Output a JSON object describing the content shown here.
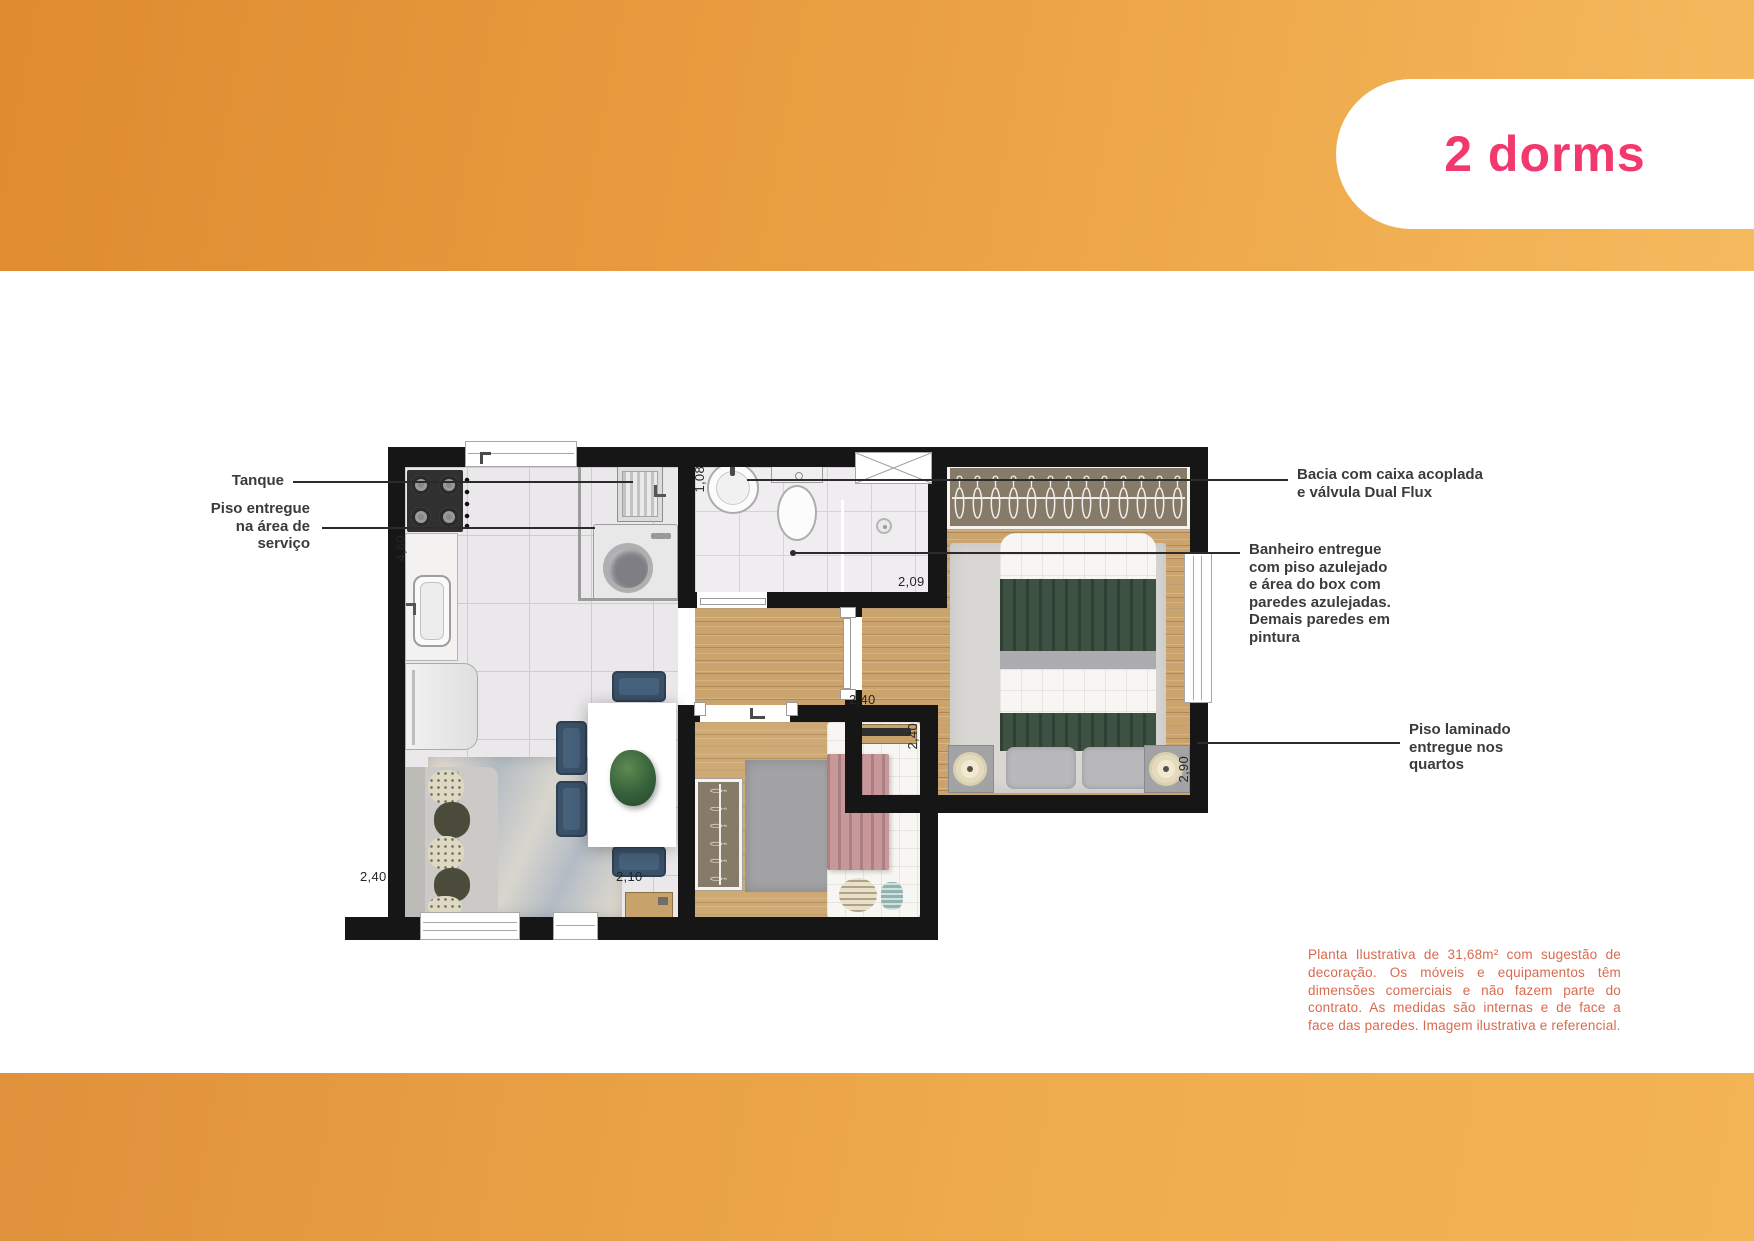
{
  "badge": {
    "label": "2 dorms"
  },
  "annotations": {
    "tanque": {
      "lines": [
        "Tanque"
      ]
    },
    "piso_servico": {
      "lines": [
        "Piso entregue",
        "na área de",
        "serviço"
      ]
    },
    "bacia": {
      "lines": [
        "Bacia com caixa acoplada",
        "e válvula Dual Flux"
      ]
    },
    "banheiro": {
      "lines": [
        "Banheiro entregue",
        "com piso azulejado",
        "e área do box com",
        "paredes azulejadas.",
        "Demais paredes em",
        "pintura"
      ]
    },
    "piso_laminado": {
      "lines": [
        "Piso laminado",
        "entregue nos",
        "quartos"
      ]
    }
  },
  "dimensions": {
    "kitchen_height": "4,60",
    "bathroom_width": "1,08",
    "bathroom_length": "2,09",
    "master_width": "2,40",
    "master_depth": "2,90",
    "bedroom2_depth": "2,40",
    "bedroom2_width": "2,10",
    "living_width": "2,40"
  },
  "disclaimer": "Planta Ilustrativa de 31,68m² com sugestão de decoração. Os móveis e equipamentos têm dimensões comerciais e não fazem parte do contrato. As medidas são internas e de face a face das paredes. Imagem ilustrativa e referencial.",
  "colors": {
    "band_orange": "#EBA244",
    "badge_pink": "#F2386C",
    "wall": "#161616",
    "disclaimer_text": "#D96A4E",
    "label_text": "#3B3B3B"
  },
  "plan": {
    "master_closet_hangers": 13,
    "bedroom2_closet_hangers": 6
  }
}
